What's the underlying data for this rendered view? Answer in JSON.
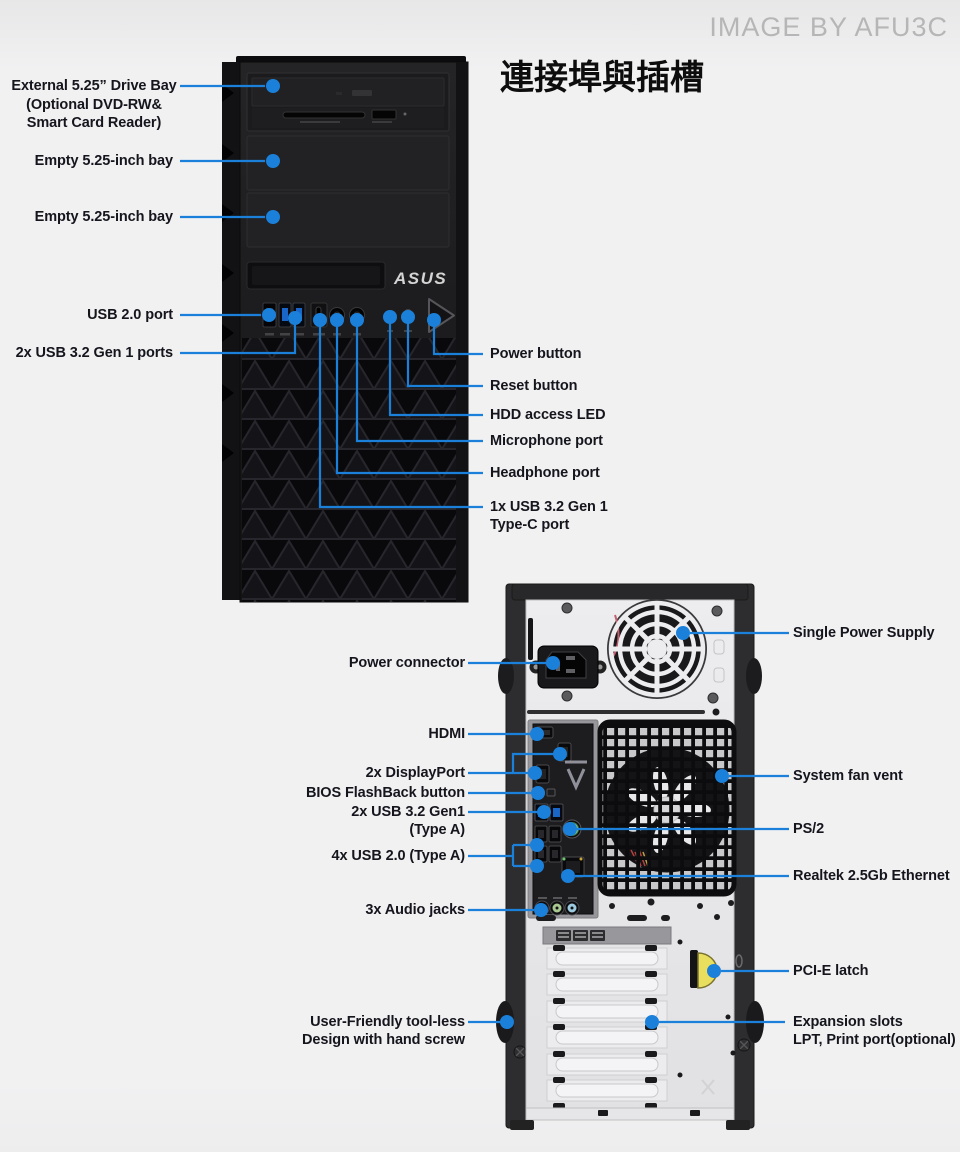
{
  "watermark": "IMAGE BY AFU3C",
  "title": "連接埠與插槽",
  "branding": {
    "asus": "ASUS",
    "tuf": "TUF"
  },
  "front_labels": {
    "drive_bay_1": "External 5.25” Drive Bay",
    "drive_bay_2": "(Optional DVD-RW&",
    "drive_bay_3": "Smart Card Reader)",
    "empty_bay_top": "Empty 5.25-inch bay",
    "empty_bay_bottom": "Empty 5.25-inch bay",
    "usb2": "USB 2.0 port",
    "usb32": "2x USB 3.2 Gen 1 ports",
    "power_button": "Power button",
    "reset_button": "Reset button",
    "hdd_led": "HDD access LED",
    "microphone": "Microphone port",
    "headphone": "Headphone port",
    "usbc_1": "1x USB 3.2 Gen 1",
    "usbc_2": "Type-C port"
  },
  "rear_labels": {
    "power_connector": "Power connector",
    "hdmi": "HDMI",
    "displayport": "2x DisplayPort",
    "bios_flashback": "BIOS FlashBack button",
    "usb32_1": "2x USB 3.2 Gen1",
    "usb32_2": "(Type A)",
    "usb20": "4x USB 2.0 (Type A)",
    "audio_jacks": "3x Audio jacks",
    "toolless_1": "User-Friendly tool-less",
    "toolless_2": "Design with hand screw",
    "power_supply": "Single Power Supply",
    "fan_vent": "System fan vent",
    "ps2": "PS/2",
    "ethernet": "Realtek 2.5Gb Ethernet",
    "pcie_latch": "PCI-E latch",
    "expansion_1": "Expansion slots",
    "expansion_2": "LPT, Print port(optional)"
  },
  "colors": {
    "callout": "#1b80da",
    "label_text": "#15151d",
    "watermark": "#b6b6b6",
    "usb3_blue": "#1966c8",
    "ps2_green": "#8cc88c",
    "audio_pink": "#d898aa",
    "audio_green": "#a8c890",
    "audio_blue": "#9ccade",
    "latch_yellow": "#e8df5e"
  }
}
